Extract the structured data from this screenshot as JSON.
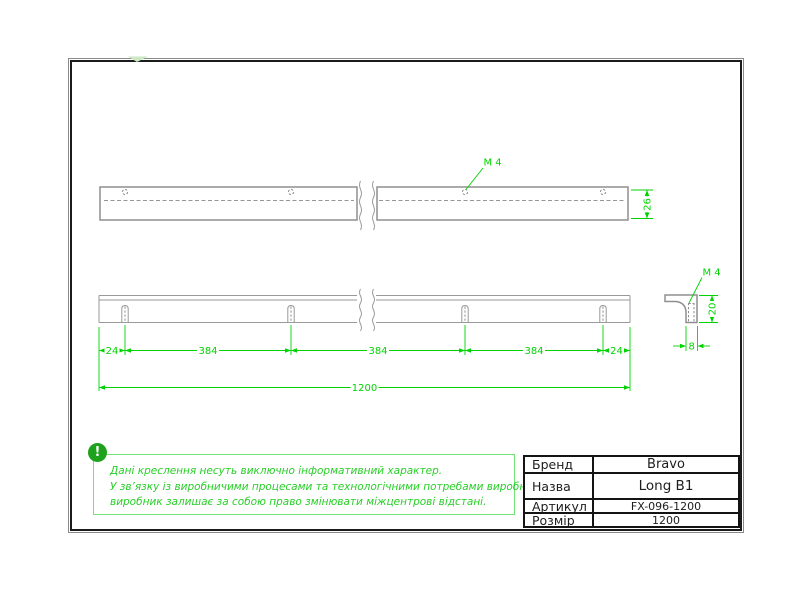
{
  "drawing": {
    "top_view": {
      "thread_label": "M 4",
      "height_dim": "26"
    },
    "side_view": {
      "dims": [
        "24",
        "384",
        "384",
        "384",
        "24"
      ],
      "total_dim": "1200"
    },
    "end_view": {
      "thread_label": "M 4",
      "height_dim": "20",
      "thickness_dim": "8"
    }
  },
  "note": {
    "icon_glyph": "!",
    "lines": [
      "Дані креслення несуть виключно інформативний характер.",
      "У зв’язку із виробничими процесами та технологічними потребами виробництва,",
      "виробник залишає за собою право змінювати міжцентрові відстані."
    ]
  },
  "title_block": {
    "rows": [
      {
        "label": "Бренд",
        "value": "Bravo"
      },
      {
        "label": "Назва",
        "value": "Long B1"
      },
      {
        "label": "Артикул",
        "value": "FX-096-1200"
      },
      {
        "label": "Розмір",
        "value": "1200"
      }
    ]
  },
  "colors": {
    "dimension_green": "#00d300",
    "note_green": "#28cf28",
    "note_border_green": "#72e472",
    "icon_green": "#1ca21c",
    "outline_gray": "#8f8f8f",
    "table_black": "#141414"
  }
}
